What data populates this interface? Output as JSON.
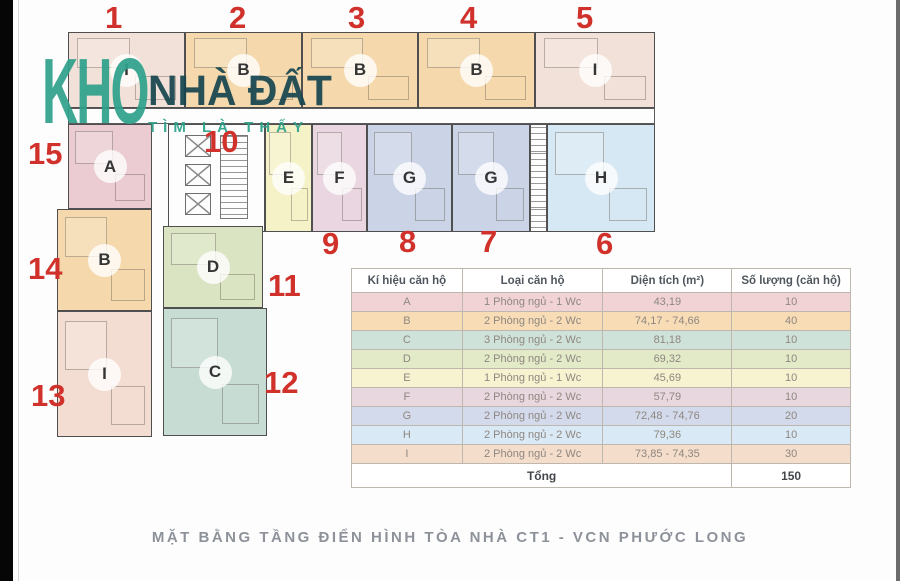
{
  "watermark": {
    "brand": "KHO",
    "brand2": "NHÀ ĐẤT",
    "tagline": "TÌM LÀ THẤY",
    "teal_color": "#2ea18c",
    "dark_color": "#16454f"
  },
  "caption": "MẶT BẰNG TẦNG ĐIỂN HÌNH TÒA NHÀ CT1 - VCN PHƯỚC LONG",
  "plan": {
    "number_color": "#d1312b",
    "units": [
      {
        "no": "1",
        "letter": "I",
        "color": "#f2e1d8"
      },
      {
        "no": "2",
        "letter": "B",
        "color": "#f5d9ad"
      },
      {
        "no": "3",
        "letter": "B",
        "color": "#f5d9ad"
      },
      {
        "no": "4",
        "letter": "B",
        "color": "#f5d9ad"
      },
      {
        "no": "5",
        "letter": "I",
        "color": "#f2e1d8"
      },
      {
        "no": "6",
        "letter": "H",
        "color": "#d6e8f3"
      },
      {
        "no": "7",
        "letter": "G",
        "color": "#cbd3e7"
      },
      {
        "no": "8",
        "letter": "G",
        "color": "#cbd3e7"
      },
      {
        "no": "9",
        "letter": "F",
        "color": "#e9d6e0"
      },
      {
        "no": "10",
        "letter": "E",
        "color": "#f6f2c8"
      },
      {
        "no": "11",
        "letter": "D",
        "color": "#dbe4c2"
      },
      {
        "no": "12",
        "letter": "C",
        "color": "#c7ddd3"
      },
      {
        "no": "13",
        "letter": "I",
        "color": "#f3ddd2"
      },
      {
        "no": "14",
        "letter": "B",
        "color": "#f5d9ad"
      },
      {
        "no": "15",
        "letter": "A",
        "color": "#ebccd2"
      }
    ]
  },
  "table": {
    "headers": [
      "Kí hiệu căn hộ",
      "Loại căn hộ",
      "Diện tích (m²)",
      "Số lượng (căn hộ)"
    ],
    "rows": [
      {
        "code": "A",
        "type": "1 Phòng ngủ - 1 Wc",
        "area": "43,19",
        "quantity": "10",
        "color": "#f1d3d6"
      },
      {
        "code": "B",
        "type": "2 Phòng ngủ - 2 Wc",
        "area": "74,17 - 74,66",
        "quantity": "40",
        "color": "#f7dcb6"
      },
      {
        "code": "C",
        "type": "3 Phòng ngủ - 2 Wc",
        "area": "81,18",
        "quantity": "10",
        "color": "#cfe2d9"
      },
      {
        "code": "D",
        "type": "2 Phòng ngủ - 2 Wc",
        "area": "69,32",
        "quantity": "10",
        "color": "#e2eac8"
      },
      {
        "code": "E",
        "type": "1 Phòng ngủ - 1 Wc",
        "area": "45,69",
        "quantity": "10",
        "color": "#f7f2cf"
      },
      {
        "code": "F",
        "type": "2 Phòng ngủ - 2 Wc",
        "area": "57,79",
        "quantity": "10",
        "color": "#e9d7e0"
      },
      {
        "code": "G",
        "type": "2 Phòng ngủ - 2 Wc",
        "area": "72,48 - 74,76",
        "quantity": "20",
        "color": "#d3daec"
      },
      {
        "code": "H",
        "type": "2 Phòng ngủ - 2 Wc",
        "area": "79,36",
        "quantity": "10",
        "color": "#d9e9f5"
      },
      {
        "code": "I",
        "type": "2 Phòng ngủ - 2 Wc",
        "area": "73,85 - 74,35",
        "quantity": "30",
        "color": "#f4ddcb"
      }
    ],
    "total_label": "Tổng",
    "total_value": "150"
  }
}
